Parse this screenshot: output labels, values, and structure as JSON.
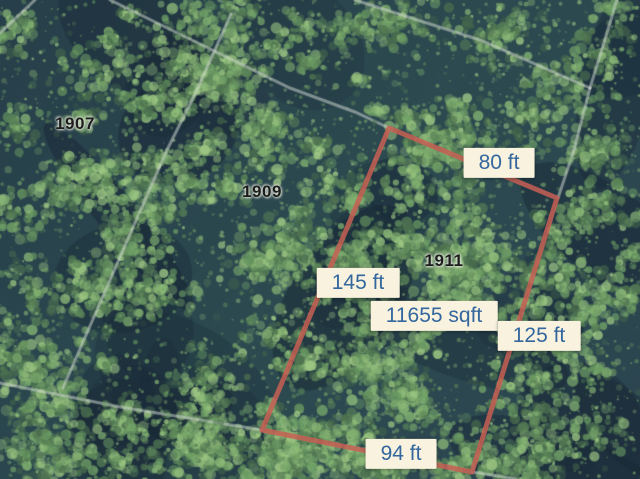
{
  "map": {
    "title": "Aerial parcel map",
    "parcels": [
      {
        "number": "1907",
        "x": 75,
        "y": 124
      },
      {
        "number": "1909",
        "x": 262,
        "y": 192
      },
      {
        "number": "1911",
        "x": 444,
        "y": 261
      }
    ],
    "measurement_labels": [
      {
        "text": "80 ft",
        "x": 499,
        "y": 163
      },
      {
        "text": "145 ft",
        "x": 358,
        "y": 283
      },
      {
        "text": "11655 sqft",
        "x": 434,
        "y": 316
      },
      {
        "text": "125 ft",
        "x": 539,
        "y": 336
      },
      {
        "text": "94 ft",
        "x": 401,
        "y": 454
      }
    ],
    "highlighted_parcel": {
      "number": "1911",
      "area_label": "11655 sqft",
      "side_labels": [
        "80 ft",
        "125 ft",
        "94 ft",
        "145 ft"
      ],
      "vertices": [
        [
          389,
          128
        ],
        [
          557,
          198
        ],
        [
          472,
          472
        ],
        [
          262,
          430
        ]
      ]
    },
    "colors": {
      "outline": "#c75f53",
      "label_background": "#f8f2df",
      "label_text": "#33679e",
      "parcel_number_text": "#1d1d1d",
      "lot_line": "#d5ddd5"
    }
  }
}
